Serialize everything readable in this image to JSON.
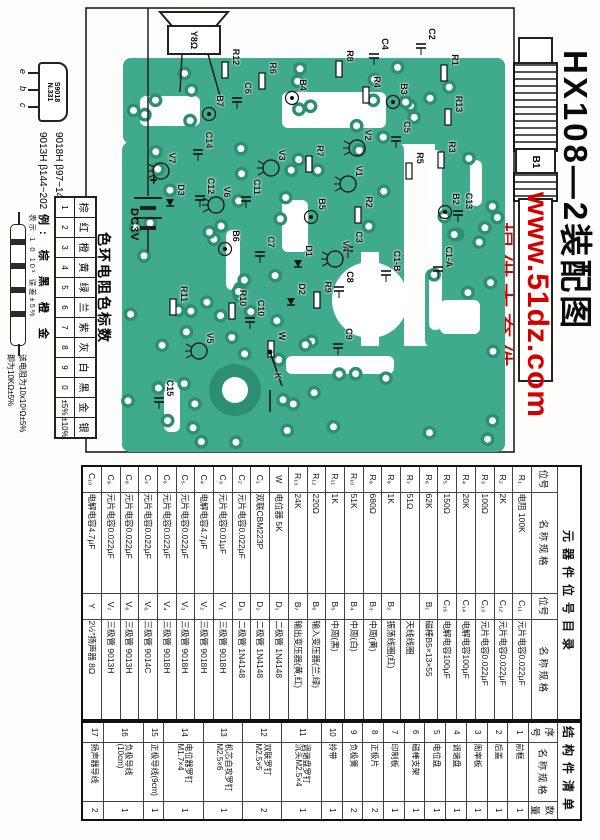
{
  "title": "HX108—2装配图",
  "watermark": {
    "url": "www.51dz.com",
    "slogan": "提供本套件",
    "color": "#d40000"
  },
  "antenna": {
    "label": "B1"
  },
  "pcb": {
    "board_color": "#3fab8c",
    "pad_ring_color": "#2d8f72",
    "speaker_label": "Y8Ω",
    "battery": {
      "plus": "+",
      "label": "DC3V"
    },
    "labels": [
      {
        "t": "R12",
        "x": 57,
        "y": 364
      },
      {
        "t": "C6",
        "x": 88,
        "y": 352
      },
      {
        "t": "R6",
        "x": 68,
        "y": 327
      },
      {
        "t": "B4",
        "x": 85,
        "y": 297
      },
      {
        "t": "R8",
        "x": 56,
        "y": 250
      },
      {
        "t": "R4",
        "x": 82,
        "y": 223
      },
      {
        "t": "B3",
        "x": 89,
        "y": 196
      },
      {
        "t": "C4",
        "x": 44,
        "y": 215
      },
      {
        "t": "C2",
        "x": 34,
        "y": 168
      },
      {
        "t": "R1",
        "x": 60,
        "y": 145
      },
      {
        "t": "R13",
        "x": 104,
        "y": 141
      },
      {
        "t": "B7",
        "x": 101,
        "y": 380
      },
      {
        "t": "C14",
        "x": 140,
        "y": 391
      },
      {
        "t": "V7",
        "x": 158,
        "y": 428
      },
      {
        "t": "D3",
        "x": 190,
        "y": 419
      },
      {
        "t": "C12",
        "x": 186,
        "y": 389
      },
      {
        "t": "V6",
        "x": 192,
        "y": 373
      },
      {
        "t": "C11",
        "x": 187,
        "y": 343
      },
      {
        "t": "V3",
        "x": 155,
        "y": 318
      },
      {
        "t": "R7",
        "x": 151,
        "y": 280
      },
      {
        "t": "V2",
        "x": 135,
        "y": 232
      },
      {
        "t": "C5",
        "x": 127,
        "y": 193
      },
      {
        "t": "R3",
        "x": 147,
        "y": 148
      },
      {
        "t": "R5",
        "x": 158,
        "y": 180
      },
      {
        "t": "V1",
        "x": 171,
        "y": 241
      },
      {
        "t": "B5",
        "x": 204,
        "y": 278
      },
      {
        "t": "R2",
        "x": 202,
        "y": 231
      },
      {
        "t": "B2",
        "x": 199,
        "y": 144
      },
      {
        "t": "C13",
        "x": 201,
        "y": 131
      },
      {
        "t": "B6",
        "x": 236,
        "y": 364
      },
      {
        "t": "C7",
        "x": 242,
        "y": 329
      },
      {
        "t": "C3",
        "x": 237,
        "y": 241
      },
      {
        "t": "V4",
        "x": 246,
        "y": 254
      },
      {
        "t": "C1-B",
        "x": 261,
        "y": 203
      },
      {
        "t": "C1-A",
        "x": 257,
        "y": 151
      },
      {
        "t": "D1",
        "x": 251,
        "y": 291
      },
      {
        "t": "D2",
        "x": 289,
        "y": 298
      },
      {
        "t": "R9",
        "x": 287,
        "y": 272
      },
      {
        "t": "C8",
        "x": 277,
        "y": 250
      },
      {
        "t": "C9",
        "x": 334,
        "y": 251
      },
      {
        "t": "R11",
        "x": 294,
        "y": 416
      },
      {
        "t": "R10",
        "x": 298,
        "y": 357
      },
      {
        "t": "C10",
        "x": 308,
        "y": 339
      },
      {
        "t": "V5",
        "x": 338,
        "y": 390
      },
      {
        "t": "W",
        "x": 336,
        "y": 318
      },
      {
        "t": "K",
        "x": 376,
        "y": 322
      },
      {
        "t": "C15",
        "x": 388,
        "y": 430
      }
    ]
  },
  "transistor_info": {
    "marking_line1": "S9018",
    "marking_line2": "N.331",
    "pins": [
      "e",
      "b",
      "c"
    ],
    "spec_line1": "9018H  β97~146",
    "spec_line2": "9013H  β144~202"
  },
  "color_code": {
    "title": "色环电阻色标数",
    "columns": [
      {
        "c": "棕",
        "v": "1"
      },
      {
        "c": "红",
        "v": "2"
      },
      {
        "c": "橙",
        "v": "3"
      },
      {
        "c": "黄",
        "v": "4"
      },
      {
        "c": "绿",
        "v": "5"
      },
      {
        "c": "兰",
        "v": "6"
      },
      {
        "c": "紫",
        "v": "7"
      },
      {
        "c": "灰",
        "v": "8"
      },
      {
        "c": "白",
        "v": "9"
      },
      {
        "c": "黑",
        "v": "0"
      },
      {
        "c": "金",
        "v": "±5%"
      },
      {
        "c": "银",
        "v": "±10%"
      }
    ],
    "example": {
      "line": "例: 棕 黑 橙 金",
      "note": "表示 1  0  10³  误差±5%",
      "calc1": "该电阻为10x10³Ω±5%",
      "calc2": "即为10KΩ±5%"
    }
  },
  "parts_table": {
    "left": {
      "title": "元器件位号目录",
      "headers": [
        "位号",
        "名 称 规 格",
        "位号",
        "名 称 规 格"
      ],
      "rows": [
        [
          "R₁",
          "电阻 100K",
          "C₁₁",
          "元片电容0.022μF"
        ],
        [
          "R₂",
          "2K",
          "C₁₂",
          "元片电容0.022μF"
        ],
        [
          "R₃",
          "100Ω",
          "C₁₃",
          "元片电容0.022μF"
        ],
        [
          "R₄",
          "20K",
          "C₁₄",
          "电解电容100μF"
        ],
        [
          "R₅",
          "150Ω",
          "C₁₅",
          "电解电容100μF"
        ],
        [
          "R₆",
          "62K",
          "B₁",
          "磁棒B5×13×55"
        ],
        [
          "R₇",
          "51Ω",
          "",
          "天线线圈"
        ],
        [
          "R₈",
          "1K",
          "B₂",
          "振荡线圈(红)"
        ],
        [
          "R₉",
          "680Ω",
          "B₃",
          "中周(黄)"
        ],
        [
          "R₁₀",
          "51K",
          "B₄",
          "中周(白)"
        ],
        [
          "R₁₁",
          "1K",
          "B₅",
          "中周(黑)"
        ],
        [
          "R₁₂",
          "220Ω",
          "B₆",
          "输入变压器(兰,绿)"
        ],
        [
          "R₁₃",
          "24K",
          "B₇",
          "输出变压器(黄,红)"
        ],
        [
          "W",
          "电位器 5K",
          "D₁",
          "二极管 1N4148"
        ],
        [
          "C₁",
          "双联CBM223P",
          "D₂",
          "二极管 1N4148"
        ],
        [
          "C₂",
          "元片电容0.022μF",
          "D₃",
          "二极管 1N4148"
        ],
        [
          "C₃",
          "元片电容0.01μF",
          "V₁",
          "三极管 9018H"
        ],
        [
          "C₄",
          "电解电容4.7μF",
          "V₂",
          "三极管 9018H"
        ],
        [
          "C₅",
          "元片电容0.022μF",
          "V₃",
          "三极管 9018H"
        ],
        [
          "C₆",
          "元片电容0.022μF",
          "V₄",
          "三极管 9018H"
        ],
        [
          "C₇",
          "元片电容0.022μF",
          "V₅",
          "三极管 9014C"
        ],
        [
          "C₈",
          "元片电容0.022μF",
          "V₆",
          "三极管 9013H"
        ],
        [
          "C₉",
          "元片电容0.022μF",
          "V₇",
          "三极管 9013H"
        ],
        [
          "C₁₀",
          "电解电容4.7μF",
          "Y",
          "2½″扬声器 8Ω"
        ]
      ]
    },
    "right": {
      "title": "结构件清单",
      "headers": [
        "序号",
        "名 称 规 格",
        "数量"
      ],
      "rows": [
        [
          "1",
          "前框",
          "1"
        ],
        [
          "2",
          "后盖",
          "1"
        ],
        [
          "3",
          "周率板",
          "1"
        ],
        [
          "4",
          "调谐盘",
          "1"
        ],
        [
          "5",
          "电位盘",
          "1"
        ],
        [
          "6",
          "磁棒支架",
          "1"
        ],
        [
          "7",
          "印制板",
          "1"
        ],
        [
          "8",
          "正极片",
          "2"
        ],
        [
          "9",
          "负极簧",
          "2"
        ],
        [
          "10",
          "拎带",
          "1"
        ],
        [
          "11",
          "调谐盘罗钉\n沉头M2.5×4",
          "1"
        ],
        [
          "12",
          "双联罗钉\nM2.5×5",
          "2"
        ],
        [
          "13",
          "机芯自攻罗钉\nM2.5×6",
          "1"
        ],
        [
          "14",
          "电位器罗钉\nM1.7×4",
          "1"
        ],
        [
          "15",
          "正极导线(9cm)",
          "1"
        ],
        [
          "16",
          "负极导线(10cm)",
          "1"
        ],
        [
          "17",
          "扬声器导线",
          "2"
        ]
      ]
    }
  }
}
